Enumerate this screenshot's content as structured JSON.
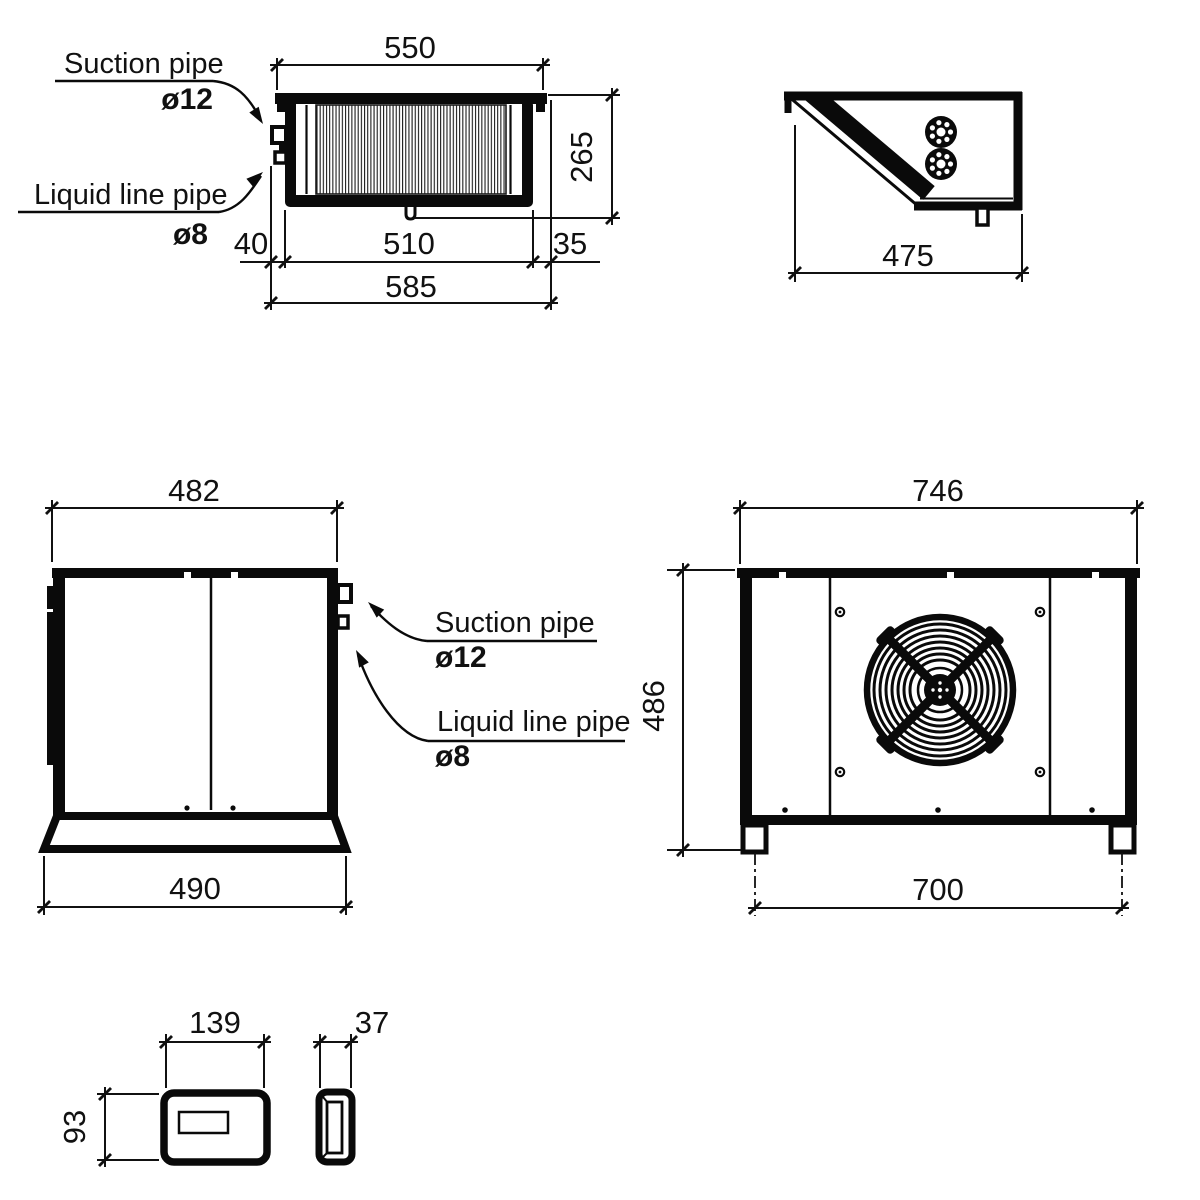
{
  "pipe_labels": {
    "suction": "Suction pipe",
    "suction_diameter": "ø12",
    "liquid": "Liquid line pipe",
    "liquid_diameter": "ø8"
  },
  "views": {
    "top": {
      "dims": {
        "coil_width": "550",
        "depth": "265",
        "pipe_offset": "40",
        "body_width": "510",
        "right_offset": "35",
        "overall_width": "585"
      }
    },
    "top_angled": {
      "dims": {
        "depth": "475"
      }
    },
    "side": {
      "dims": {
        "top_width": "482",
        "base_width": "490"
      }
    },
    "front": {
      "dims": {
        "overall_width": "746",
        "height": "486",
        "feet_span": "700"
      }
    },
    "controller": {
      "dims": {
        "width": "139",
        "height": "93",
        "depth": "37"
      }
    }
  }
}
